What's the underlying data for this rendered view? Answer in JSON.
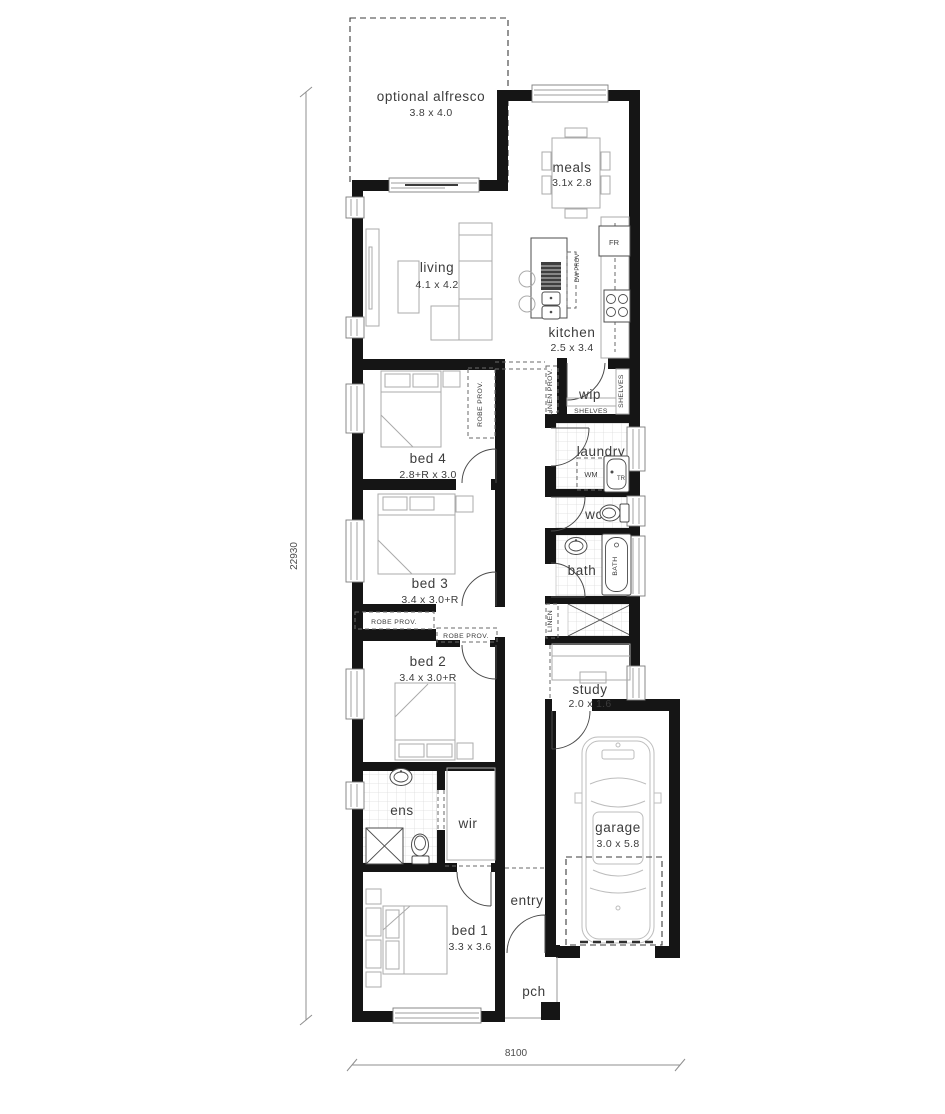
{
  "title": "single storey narrow lot floor plan",
  "dimensions": {
    "overall_depth": "22930",
    "overall_width": "8100"
  },
  "rooms": {
    "alfresco": {
      "name": "optional alfresco",
      "size": "3.8 x 4.0"
    },
    "meals": {
      "name": "meals",
      "size": "3.1x 2.8"
    },
    "living": {
      "name": "living",
      "size": "4.1 x 4.2"
    },
    "kitchen": {
      "name": "kitchen",
      "size": "2.5 x 3.4"
    },
    "bed4": {
      "name": "bed 4",
      "size": "2.8+R x 3.0"
    },
    "wip": {
      "name": "wip"
    },
    "laundry": {
      "name": "laundry"
    },
    "wc": {
      "name": "wc"
    },
    "bath": {
      "name": "bath"
    },
    "bed3": {
      "name": "bed 3",
      "size": "3.4 x 3.0+R"
    },
    "bed2": {
      "name": "bed 2",
      "size": "3.4 x 3.0+R"
    },
    "study": {
      "name": "study",
      "size": "2.0 x 1.6"
    },
    "garage": {
      "name": "garage",
      "size": "3.0 x 5.8"
    },
    "ens": {
      "name": "ens"
    },
    "wir": {
      "name": "wir"
    },
    "bed1": {
      "name": "bed 1",
      "size": "3.3 x 3.6"
    },
    "entry": {
      "name": "entry"
    },
    "pch": {
      "name": "pch"
    }
  },
  "annotations": {
    "robe_prov": "ROBE PROV.",
    "linen_prov": "LINEN PROV.",
    "shelves": "SHELVES",
    "linen": "LINEN",
    "wm": "WM",
    "tr": "TR",
    "fr": "FR",
    "dw_prov": "DW PROV",
    "bath_tub": "BATH"
  },
  "colors": {
    "wall": "#151515",
    "paper": "#ffffff",
    "furniture": "#ababab"
  }
}
